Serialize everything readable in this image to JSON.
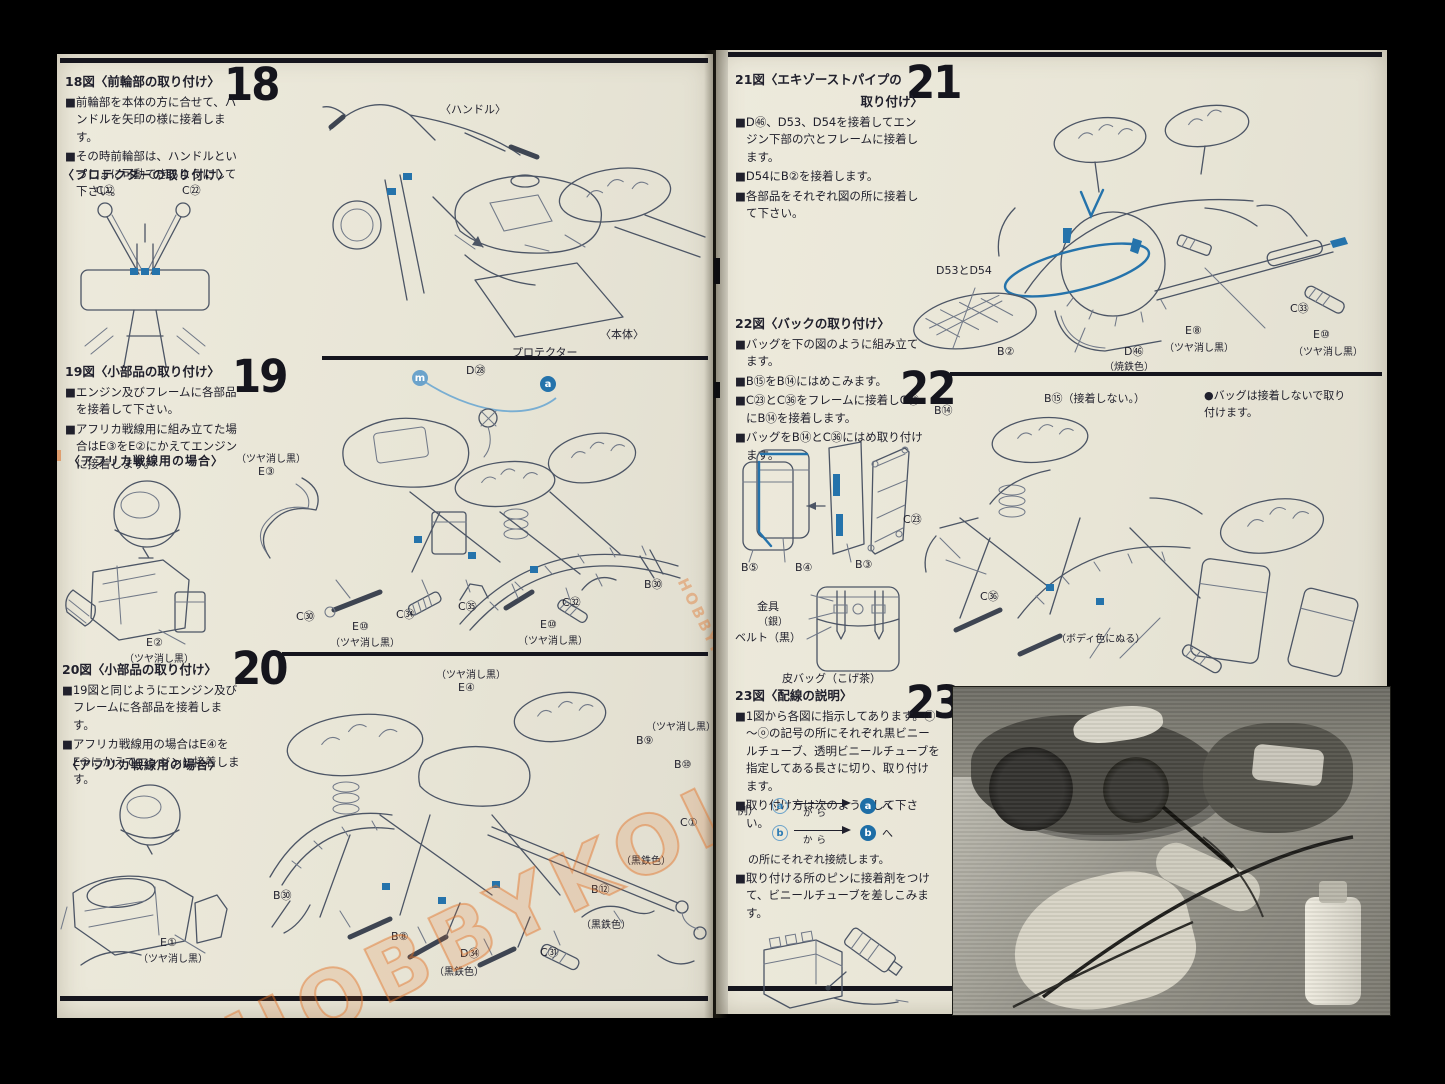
{
  "colors": {
    "paper": "#e9e6d8",
    "ink": "#20202c",
    "accent_blue": "#2573ab",
    "light_blue": "#6ba3cb",
    "rule_black": "#15151d",
    "watermark_orange": "#e27026"
  },
  "watermark": "HOBBYKOLLECTIBLES",
  "left": {
    "s18": {
      "num": "18",
      "title": "18図〈前輪部の取り付け〉",
      "b1": "■前輪部を本体の方に合せて、ハンドルを矢印の様に接着します。",
      "b2": "■その時前輪部は、ハンドルといっしょに可動できるようにして下さい。",
      "sub": "〈プロテクターの取り付け〉",
      "c22_left": "C㉒",
      "c22_right": "C㉒",
      "label_handle": "〈ハンドル〉",
      "label_body": "〈本体〉",
      "label_protector": "プロテクター"
    },
    "s19": {
      "num": "19",
      "title": "19図〈小部品の取り付け〉",
      "b1": "■エンジン及びフレームに各部品を接着して下さい。",
      "b2": "■アフリカ戦線用に組み立てた場合はE③をE②にかえてエンジンに接着します。",
      "sub": "〈アフリカ戦線用の場合〉",
      "e2": "E②",
      "e2_note": "（ツヤ消し黒）",
      "e3_note": "（ツヤ消し黒）",
      "e3": "E③",
      "marker_m": "m",
      "marker_a": "a",
      "d28": "D㉘",
      "c30": "C㉚",
      "e10_left": "E⑩",
      "e10_left_note": "（ツヤ消し黒）",
      "c34": "C㉞",
      "c35": "C㉟",
      "c32": "C㉜",
      "e10_right": "E⑩",
      "e10_right_note": "（ツヤ消し黒）",
      "b30": "B㉚"
    },
    "s20": {
      "num": "20",
      "title": "20図〈小部品の取り付け〉",
      "b1": "■19図と同じようにエンジン及びフレームに各部品を接着します。",
      "b2": "■アフリカ戦線用の場合はE④をE①にかえてエンジンに接着します。",
      "sub": "〈アフリカ戦線用の場合〉",
      "e1": "E①",
      "e1_note": "（ツヤ消し黒）",
      "e4_note": "（ツヤ消し黒）",
      "e4": "E④",
      "b9_note": "（ツヤ消し黒）",
      "b9": "B⑨",
      "b10": "B⑩",
      "c1": "C①",
      "c1_note": "（黒鉄色）",
      "b12": "B⑫",
      "b12_note": "（黒鉄色）",
      "c31": "C㉛",
      "d34": "D㉞",
      "d34_note": "（黒鉄色）",
      "b8": "B⑧",
      "b30": "B㉚"
    }
  },
  "right": {
    "s21": {
      "num": "21",
      "title1": "21図〈エキゾーストパイプの",
      "title2": "取り付け〉",
      "b1": "■D㊻、D53、D54を接着してエンジン下部の穴とフレームに接着します。",
      "b2": "■D54にB②を接着します。",
      "b3": "■各部品をそれぞれ図の所に接着して下さい。",
      "d5354": "D53とD54",
      "b2_label": "B②",
      "d46": "D㊻",
      "d46_note": "（焼鉄色）",
      "e8": "E⑧",
      "e8_note": "（ツヤ消し黒）",
      "c33": "C㉝",
      "e10": "E⑩",
      "e10_note": "（ツヤ消し黒）"
    },
    "s22": {
      "num": "22",
      "title": "22図〈バックの取り付け〉",
      "b1": "■バッグを下の図のように組み立てます。",
      "b2": "■B⑮をB⑭にはめこみます。",
      "b3": "■C㉓とC㊱をフレームに接着しC㉓にB⑭を接着します。",
      "b4": "■バッグをB⑭とC㊱にはめ取り付けます。",
      "note": "●バッグは接着しないで取り付けます。",
      "b5": "B⑤",
      "b4_label": "B④",
      "b3_label": "B③",
      "kanagu": "金具",
      "gin": "（銀）",
      "belt": "ベルト（黒）",
      "kawabag": "皮バッグ（こげ茶）",
      "b14": "B⑭",
      "b15": "B⑮（接着しない。）",
      "c23": "C㉓",
      "c36": "C㊱",
      "body_color": "（ボディ色にぬる）"
    },
    "s23": {
      "num": "23",
      "title": "23図〈配線の説明〉",
      "b1": "■1図から各図に指示してあります。ⓐ～ⓞの記号の所にそれぞれ黒ビニールチューブ、透明ビニールチューブを指定してある長さに切り、取り付けます。",
      "b2": "■取り付け方は次のようにして下さい。",
      "rei": "例）",
      "a": "a",
      "b": "b",
      "kara": "から",
      "he": "へ",
      "mid": "の所にそれぞれ接続します。",
      "b3": "■取り付ける所のピンに接着剤をつけて、ビニールチューブを差しこみます。"
    }
  }
}
